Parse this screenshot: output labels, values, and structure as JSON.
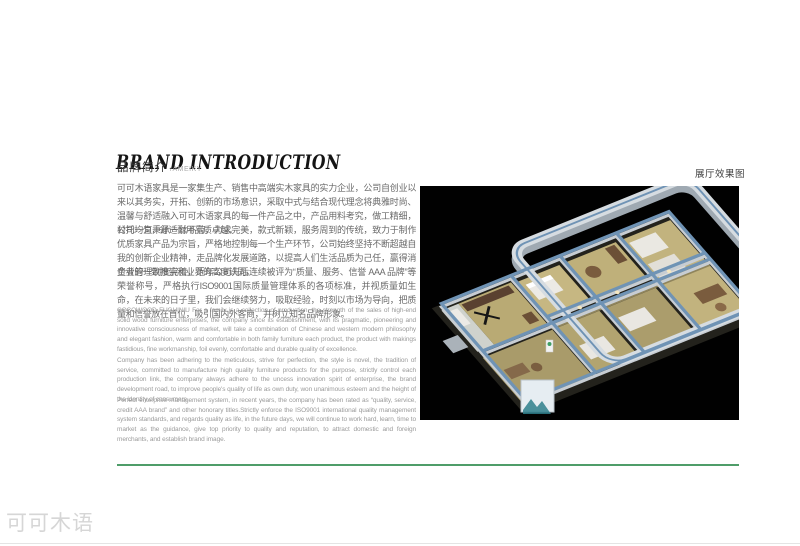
{
  "header": {
    "title": "BRAND INTRODUCTION",
    "subtitle_cn": "品牌简介",
    "subtitle_tag": "/AMEIKY"
  },
  "body": {
    "cn": [
      "可可木语家具是一家集生产、销售中高端实木家具的实力企业，公司自创业以来以其务实，开拓、创新的市场意识，采取中式与结合现代理念将典雅时尚、温馨与舒适融入可可木语家具的每一件产品之中，产品用料考究，做工精细，衬托均匀，舒适耐用品质卓越。",
      "公司一直秉承一丝不苟，力求完美，款式新颖，服务周到的传统，致力于制作优质家具产品为宗旨，严格地控制每一个生产环节，公司始终坚持不断超越自我的创新企业精神，走品牌化发展道路，以提高人们生活品质为己任，赢得消费者的一致推崇和业界的高度认同。",
      "企业管理制度完善，近年公司先后连续被评为“质量、服务、信誉 AAA 品牌”等荣誉称号，严格执行ISO9001国际质量管理体系的各项标准，并视质量如生命，在未来的日子里，我们会继续努力，吸取经验，时刻以市场为导向，把质量和信誉放在首位，吸引国内外客商，并树立知名品牌形象。"
    ],
    "en": [
      "COCOWOOD FUGUINIU For a family is a collection of production, the strength of the sales of high-end solid wood furniture enterprises, the company since its establishment, with its pragmatic, pioneering and innovative consciousness of market, will take a combination of Chinese and western modern philosophy and elegant fashion, warm and comfortable in both family furniture each product, the product with makings fastidious, fine workmanship, foil evenly, comfortable and durable quality of excellence.",
      "Company has been adhering to the meticulous, strive for perfection, the style is novel, the tradition of service, committed to manufacture high quality furniture products for the purpose, strictly control each production link, the company always adhere to the uncess innovation spirit of enterprise, the brand development road, to improve people's quality of life as own duty, won unanimous esteem and the height of the identity of consumers.",
      "Perfect enterprise management system, in recent years, the company has been rated as “quality, service, credit AAA brand” and other honorary titles.Strictly enforce the ISO9001 international quality management system standards, and regards quality as life, in the future days, we will continue to work hard, learn, time to market as the guidance, give top priority to quality and reputation, to attract domestic and foreign merchants, and establish brand image."
    ]
  },
  "render": {
    "label": "展厅效果图"
  },
  "footer": {
    "logo": "可可木语"
  },
  "colors": {
    "accent_green": "#4f9d69",
    "render_bg": "#010101",
    "wall_cap_blue": "#6f93b5"
  }
}
